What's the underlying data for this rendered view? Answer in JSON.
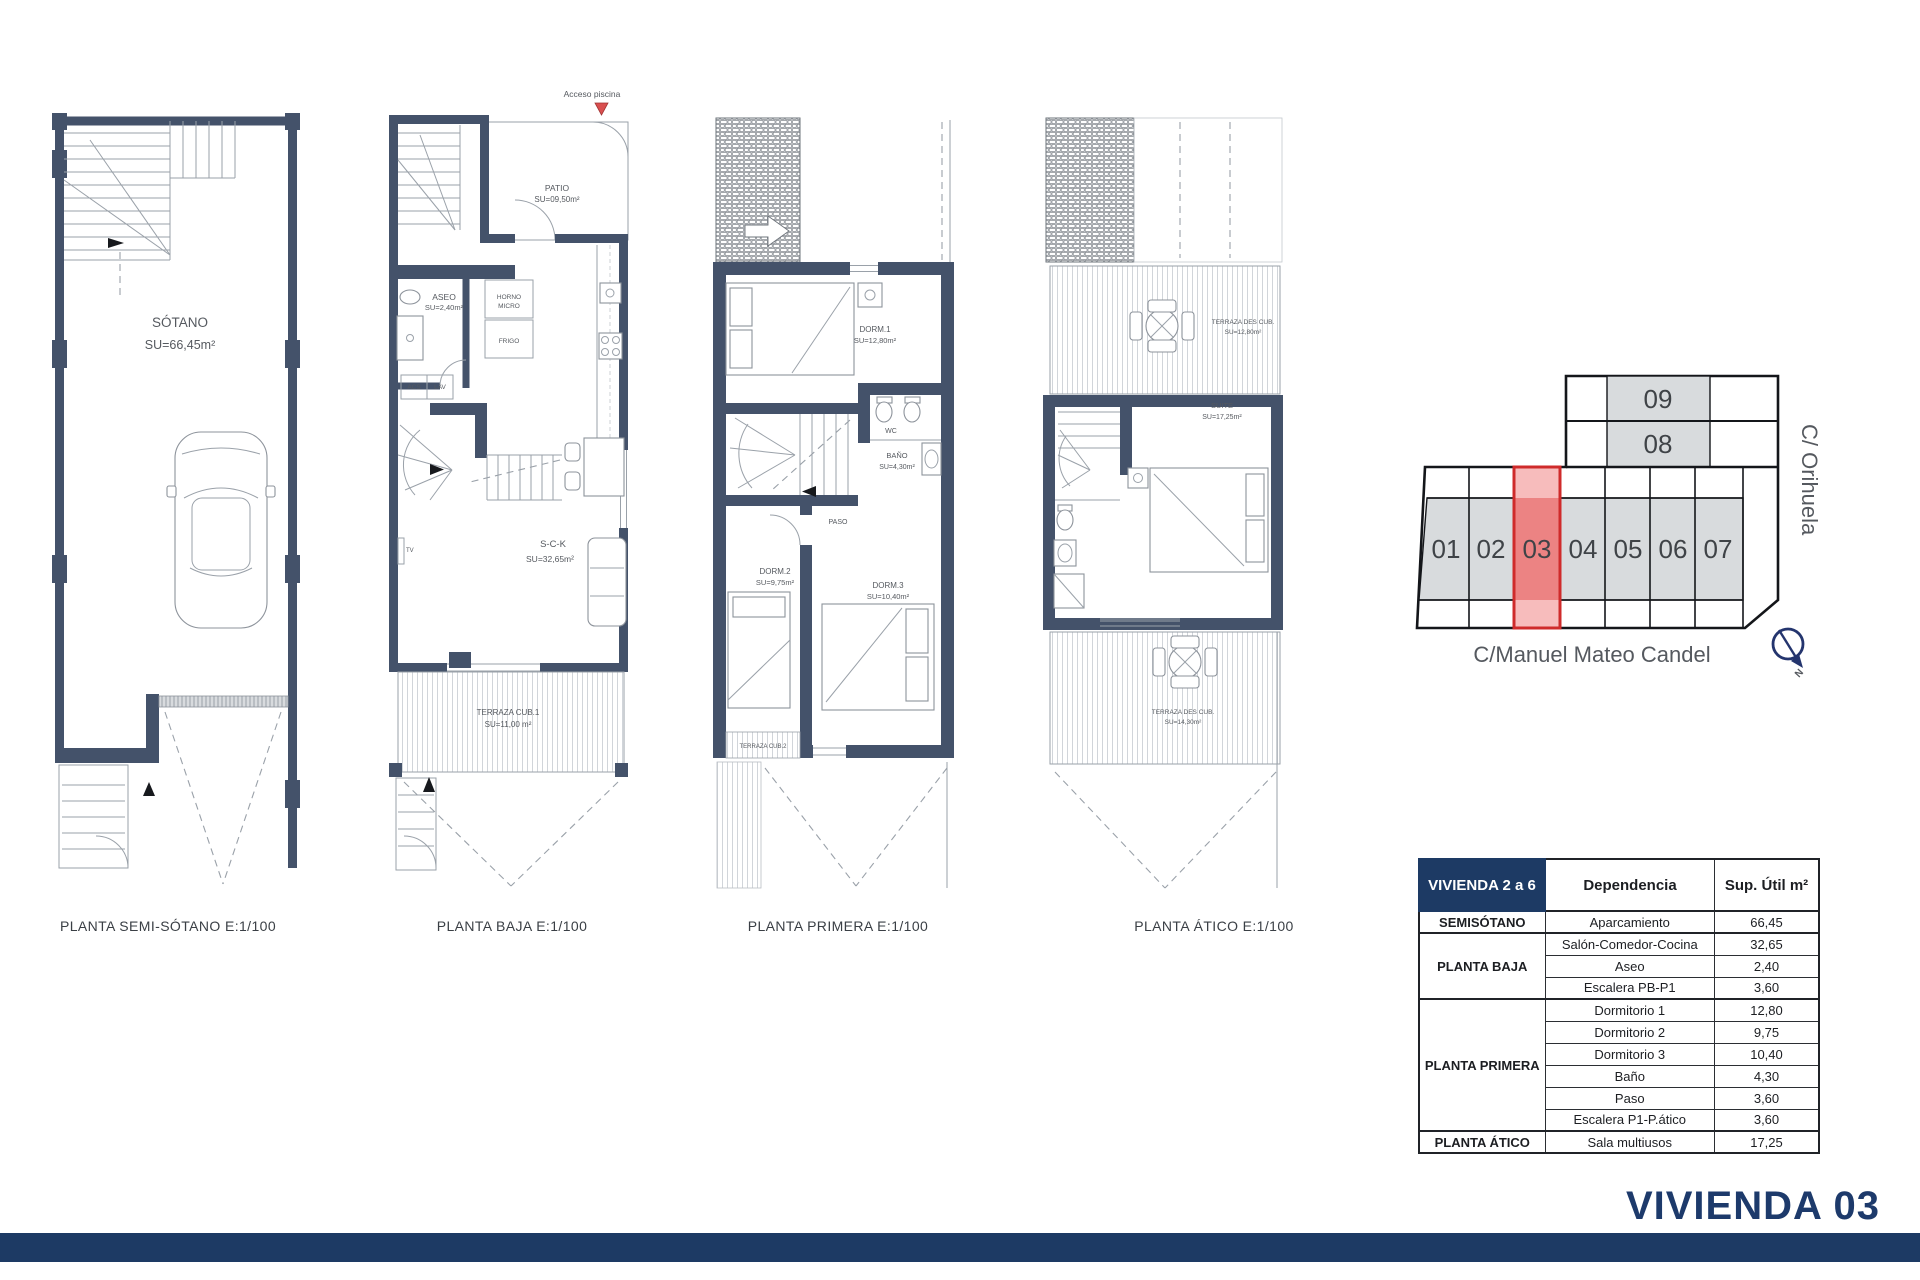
{
  "page": {
    "title_label": "VIVIENDA 03"
  },
  "plans": [
    {
      "caption": "PLANTA SEMI-SÓTANO E:1/100",
      "room": "SÓTANO",
      "room_area": "SU=66,45m²"
    },
    {
      "caption": "PLANTA BAJA E:1/100",
      "acceso": "Acceso piscina",
      "patio": "PATIO",
      "patio_area": "SU=09,50m²",
      "aseo": "ASEO",
      "aseo_area": "SU=2,40m²",
      "horno1": "HORNO",
      "horno2": "MICRO",
      "frigo": "FRIGO",
      "acs": "ACS",
      "lav": "LAV",
      "tv": "TV",
      "sck": "S-C-K",
      "sck_area": "SU=32,65m²",
      "terraza": "TERRAZA CUB.1",
      "terraza_area": "SU=11,00 m²"
    },
    {
      "caption": "PLANTA PRIMERA E:1/100",
      "dorm1": "DORM.1",
      "dorm1_area": "SU=12,80m²",
      "wc": "WC",
      "bano": "BAÑO",
      "bano_area": "SU=4,30m²",
      "paso": "PASO",
      "dorm2": "DORM.2",
      "dorm2_area": "SU=9,75m²",
      "dorm3": "DORM.3",
      "dorm3_area": "SU=10,40m²",
      "terraza2": "TERRAZA CUB.2"
    },
    {
      "caption": "PLANTA ÁTICO E:1/100",
      "terr_sup": "TERRAZA DES CUB.",
      "terr_sup_area": "SU=12,80m²",
      "suite": "SUITE",
      "suite_area": "SU=17,25m²",
      "terr_inf": "TERRAZA DES CUB.",
      "terr_inf_area": "SU=14,30m²"
    }
  ],
  "siteplan": {
    "units": [
      "01",
      "02",
      "03",
      "04",
      "05",
      "06",
      "07"
    ],
    "upper_units": [
      "09",
      "08"
    ],
    "highlight": "03",
    "highlight_color": "#cf2b2b",
    "street_bottom": "C/Manuel Mateo Candel",
    "street_right": "C/ Orihuela",
    "north": "N"
  },
  "table": {
    "col_floor": "VIVIENDA 2 a 6",
    "col_dep": "Dependencia",
    "col_sup": "Sup. Útil m²",
    "floors": [
      "SEMISÓTANO",
      "PLANTA BAJA",
      "PLANTA PRIMERA",
      "PLANTA ÁTICO"
    ],
    "rows": [
      {
        "dep": "Aparcamiento",
        "sup": "66,45"
      },
      {
        "dep": "Salón-Comedor-Cocina",
        "sup": "32,65"
      },
      {
        "dep": "Aseo",
        "sup": "2,40"
      },
      {
        "dep": "Escalera PB-P1",
        "sup": "3,60"
      },
      {
        "dep": "Dormitorio 1",
        "sup": "12,80"
      },
      {
        "dep": "Dormitorio 2",
        "sup": "9,75"
      },
      {
        "dep": "Dormitorio 3",
        "sup": "10,40"
      },
      {
        "dep": "Baño",
        "sup": "4,30"
      },
      {
        "dep": "Paso",
        "sup": "3,60"
      },
      {
        "dep": "Escalera P1-P.ático",
        "sup": "3,60"
      },
      {
        "dep": "Sala multiusos",
        "sup": "17,25"
      }
    ]
  },
  "colors": {
    "navy": "#1d3a64",
    "wall": "#44526a"
  }
}
